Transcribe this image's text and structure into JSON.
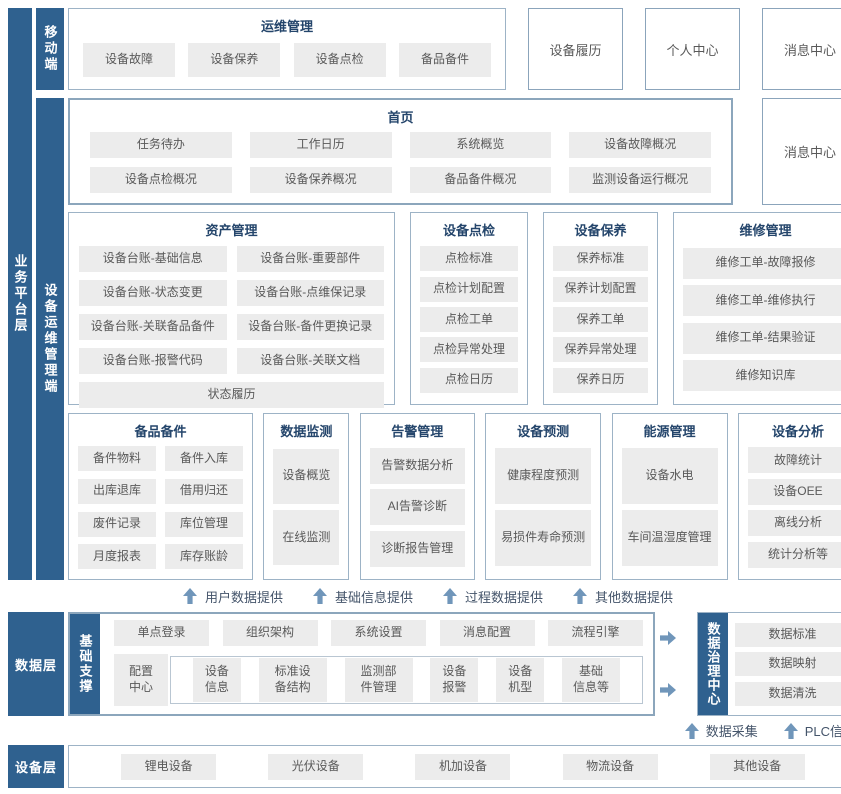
{
  "colors": {
    "accent_dark_blue": "#2f618f",
    "box_border": "#9db3c6",
    "item_bg": "#ececec",
    "item_text": "#595959",
    "title_text": "#24456b",
    "arrow_blue": "#7096ba"
  },
  "rails": {
    "business": "业务平台层",
    "mobile": "移动端",
    "ops_client": "设备运维管理端",
    "data": "数据层",
    "device": "设备层"
  },
  "mobile_section": {
    "ops": {
      "title": "运维管理",
      "items": [
        "设备故障",
        "设备保养",
        "设备点检",
        "备品备件"
      ]
    },
    "history": "设备履历",
    "personal": "个人中心",
    "message": "消息中心"
  },
  "home_section": {
    "home": {
      "title": "首页",
      "items": [
        "任务待办",
        "工作日历",
        "系统概览",
        "设备故障概况",
        "设备点检概况",
        "设备保养概况",
        "备品备件概况",
        "监测设备运行概况"
      ]
    },
    "message": "消息中心"
  },
  "modules_row1": {
    "asset": {
      "title": "资产管理",
      "items": [
        "设备台账-基础信息",
        "设备台账-重要部件",
        "设备台账-状态变更",
        "设备台账-点维保记录",
        "设备台账-关联备品备件",
        "设备台账-备件更换记录",
        "设备台账-报警代码",
        "设备台账-关联文档"
      ],
      "footer": "状态履历"
    },
    "inspection": {
      "title": "设备点检",
      "items": [
        "点检标准",
        "点检计划配置",
        "点检工单",
        "点检异常处理",
        "点检日历"
      ]
    },
    "maintenance": {
      "title": "设备保养",
      "items": [
        "保养标准",
        "保养计划配置",
        "保养工单",
        "保养异常处理",
        "保养日历"
      ]
    },
    "repair": {
      "title": "维修管理",
      "items": [
        "维修工单-故障报修",
        "维修工单-维修执行",
        "维修工单-结果验证",
        "维修知识库"
      ]
    }
  },
  "modules_row2": {
    "spare": {
      "title": "备品备件",
      "items": [
        "备件物料",
        "备件入库",
        "出库退库",
        "借用归还",
        "废件记录",
        "库位管理",
        "月度报表",
        "库存账龄"
      ]
    },
    "monitor": {
      "title": "数据监测",
      "items": [
        "设备概览",
        "在线监测"
      ]
    },
    "alarm": {
      "title": "告警管理",
      "items": [
        "告警数据分析",
        "AI告警诊断",
        "诊断报告管理"
      ]
    },
    "predict": {
      "title": "设备预测",
      "items": [
        "健康程度预测",
        "易损件寿命预测"
      ]
    },
    "energy": {
      "title": "能源管理",
      "items": [
        "设备水电",
        "车间温湿度管理"
      ]
    },
    "analysis": {
      "title": "设备分析",
      "items": [
        "故障统计",
        "设备OEE",
        "离线分析",
        "统计分析等"
      ]
    }
  },
  "provides": [
    "用户数据提供",
    "基础信息提供",
    "过程数据提供",
    "其他数据提供"
  ],
  "data_section": {
    "support_label": "基础支撑",
    "top_items": [
      "单点登录",
      "组织架构",
      "系统设置",
      "消息配置",
      "流程引擎"
    ],
    "config_cell": "配置\n中心",
    "sub_cells": [
      "设备\n信息",
      "标准设\n备结构",
      "监测部\n件管理",
      "设备\n报警",
      "设备\n机型",
      "基础\n信息等"
    ],
    "governance": {
      "label": "数据治理中心",
      "items": [
        "数据标准",
        "数据映射",
        "数据清洗"
      ]
    },
    "feeds": [
      "数据采集",
      "PLC信号"
    ]
  },
  "device_section": {
    "items": [
      "锂电设备",
      "光伏设备",
      "机加设备",
      "物流设备",
      "其他设备"
    ]
  }
}
